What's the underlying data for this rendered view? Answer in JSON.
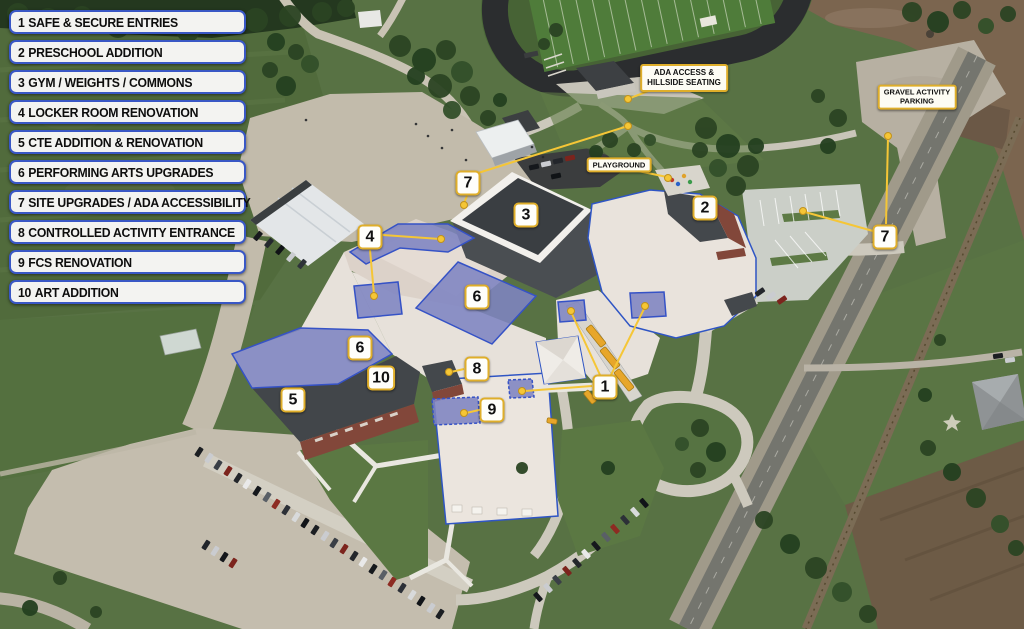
{
  "legend": {
    "items": [
      {
        "num": "1",
        "label": "SAFE & SECURE ENTRIES"
      },
      {
        "num": "2",
        "label": "PRESCHOOL ADDITION"
      },
      {
        "num": "3",
        "label": "GYM / WEIGHTS / COMMONS"
      },
      {
        "num": "4",
        "label": "LOCKER ROOM RENOVATION"
      },
      {
        "num": "5",
        "label": "CTE ADDITION & RENOVATION"
      },
      {
        "num": "6",
        "label": "PERFORMING ARTS UPGRADES"
      },
      {
        "num": "7",
        "label": "SITE UPGRADES / ADA ACCESSIBILITY"
      },
      {
        "num": "8",
        "label": "CONTROLLED ACTIVITY ENTRANCE"
      },
      {
        "num": "9",
        "label": "FCS RENOVATION"
      },
      {
        "num": "10",
        "label": "ART ADDITION"
      }
    ]
  },
  "callouts": {
    "ada_access": {
      "line1": "ADA ACCESS &",
      "line2": "HILLSIDE SEATING"
    },
    "playground": {
      "label": "PLAYGROUND"
    },
    "gravel_parking": {
      "line1": "GRAVEL ACTIVITY",
      "line2": "PARKING"
    }
  },
  "map_markers": [
    {
      "id": "7-north",
      "num": "7"
    },
    {
      "id": "3-gym",
      "num": "3"
    },
    {
      "id": "2-preschool",
      "num": "2"
    },
    {
      "id": "4-locker",
      "num": "4"
    },
    {
      "id": "6-center",
      "num": "6"
    },
    {
      "id": "6-west",
      "num": "6"
    },
    {
      "id": "10-art",
      "num": "10"
    },
    {
      "id": "5-cte",
      "num": "5"
    },
    {
      "id": "8-activity",
      "num": "8"
    },
    {
      "id": "9-fcs",
      "num": "9"
    },
    {
      "id": "1-entries",
      "num": "1"
    },
    {
      "id": "7-east",
      "num": "7"
    }
  ],
  "colors": {
    "accent_gold": "#DFAE2A",
    "leader_yellow": "#F5C636",
    "legend_border": "#3957C5",
    "overlay_purple": "#7E84C2",
    "overlay_border": "#3552C6",
    "building_outline": "#2F55C4"
  }
}
